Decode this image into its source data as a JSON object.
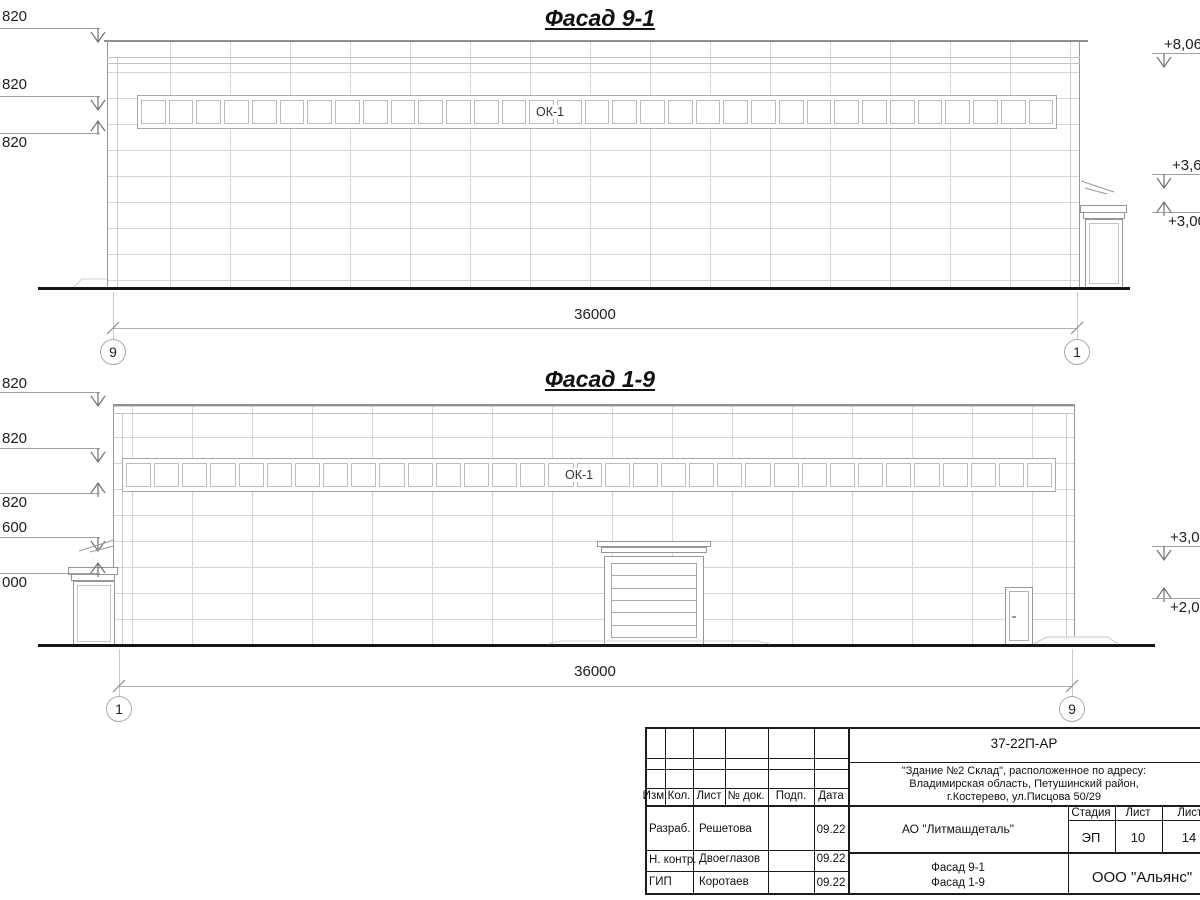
{
  "facade1": {
    "title": "Фасад 9-1",
    "window_band_label": "ОК-1",
    "window_count": 33,
    "dimension_total": "36000",
    "axis_left": "9",
    "axis_right": "1",
    "elevation_marks_left": [
      "820",
      "820",
      "820"
    ],
    "elevation_marks_right": [
      "+8,06",
      "+3,60",
      "+3,00"
    ]
  },
  "facade2": {
    "title": "Фасад 1-9",
    "window_band_label": "ОК-1",
    "window_count": 33,
    "gate_slat_count": 6,
    "dimension_total": "36000",
    "axis_left": "1",
    "axis_right": "9",
    "elevation_marks_left": [
      "820",
      "820",
      "820",
      "600",
      "000"
    ],
    "elevation_marks_right": [
      "+3,0",
      "+2,0"
    ]
  },
  "titleblock": {
    "doc_number": "37-22П-АР",
    "address": {
      "line1": "\"Здание №2 Склад\", расположенное по адресу:",
      "line2": "Владимирская область, Петушинский район,",
      "line3": "г.Костерево, ул.Писцова 50/29"
    },
    "columns": {
      "izm": "Изм.",
      "kol": "Кол.",
      "list": "Лист",
      "doc": "№ док.",
      "podp": "Подп.",
      "data": "Дата"
    },
    "rows": [
      {
        "role": "Разраб.",
        "name": "Решетова",
        "date": "09.22"
      },
      {
        "role": "Н. контр.",
        "name": "Двоеглазов",
        "date": "09.22"
      },
      {
        "role": "ГИП",
        "name": "Коротаев",
        "date": "09.22"
      }
    ],
    "client": "АО \"Литмашдеталь\"",
    "stage_label": "Стадия",
    "sheet_label": "Лист",
    "sheets_label": "Листов",
    "stage_value": "ЭП",
    "sheet_value": "10",
    "sheets_value": "14",
    "subject_line1": "Фасад 9-1",
    "subject_line2": "Фасад 1-9",
    "company": "ООО \"Альянс\""
  }
}
